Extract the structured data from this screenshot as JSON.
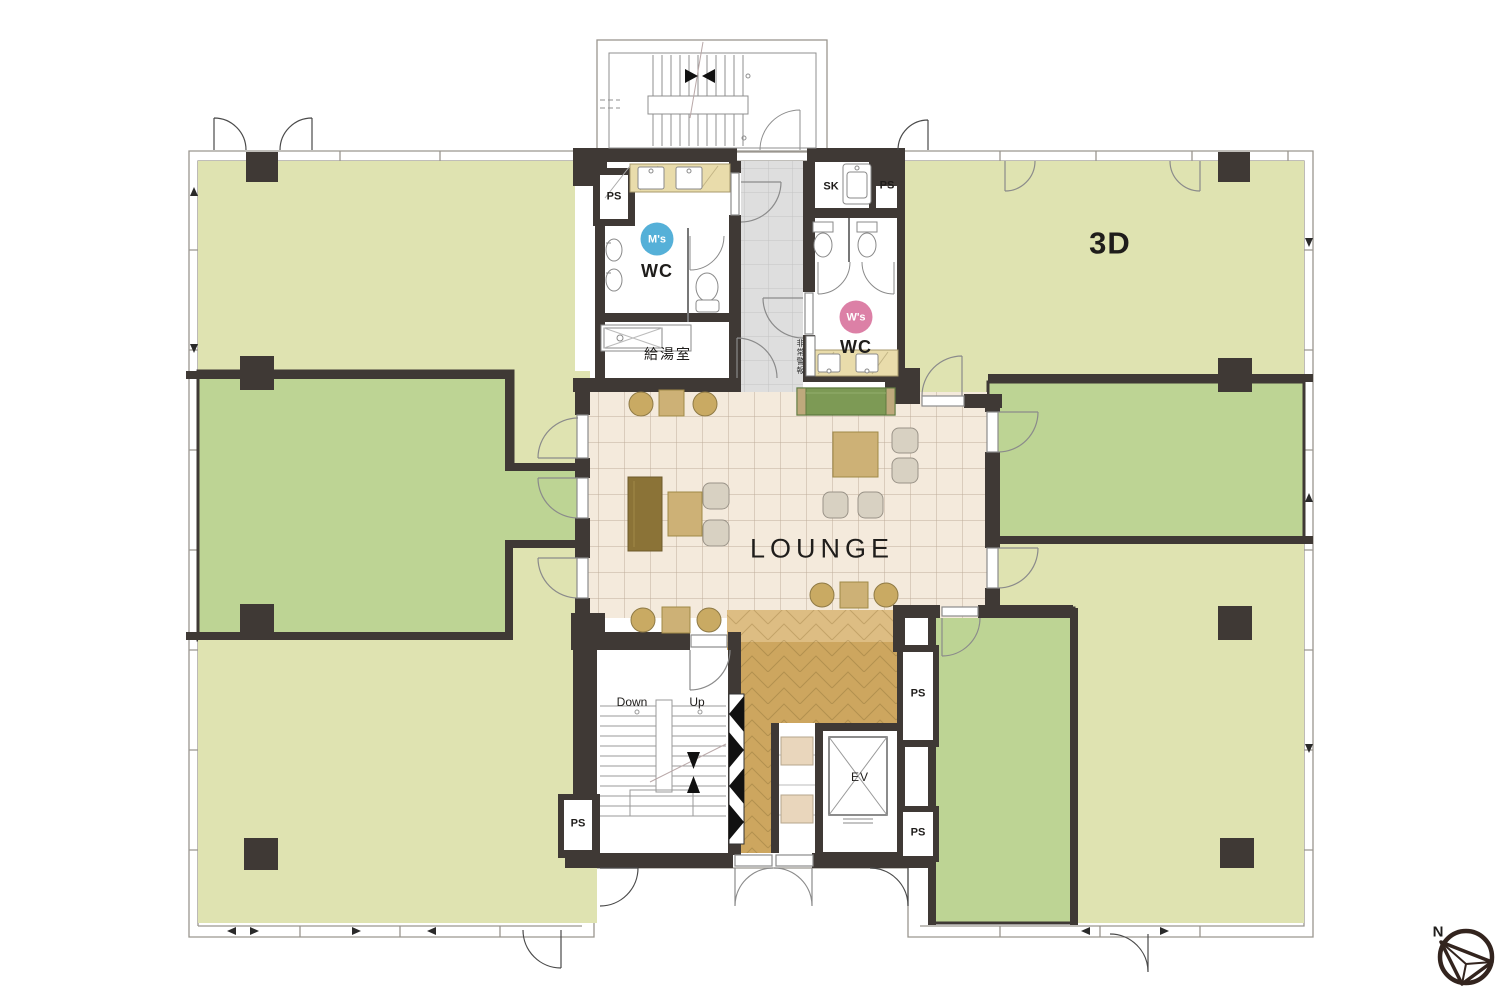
{
  "labels": {
    "tenant_room": "3D",
    "lounge": "LOUNGE",
    "mens_badge": "M's",
    "mens_wc": "WC",
    "womens_badge": "W's",
    "womens_wc": "WC",
    "kitchenette": "給湯室",
    "slop_sink": "SK",
    "elevator": "EV",
    "stair_down": "Down",
    "stair_up": "Up",
    "emergency_alarm": "非常警報",
    "north": "N",
    "pipe_shafts": [
      "PS",
      "PS",
      "PS",
      "PS",
      "PS"
    ]
  },
  "colors": {
    "wall": "#3f3935",
    "line": "#9a968f",
    "roomPale": "#dfe3b1",
    "roomGreen": "#bdd494",
    "loungeTile": "#f4eadc",
    "loungeGrid": "#bfae9b",
    "corridorTile": "#dedede",
    "corridorGrid": "#c4c4c4",
    "wood": "#cda65f",
    "woodLight": "#ddbd83",
    "woodLine": "#9c7e42",
    "counter": "#e9dcab",
    "cell": "#e9d6bc",
    "furnTan": "#cdb176",
    "furnDark": "#8b7337",
    "sofa": "#7d9a55",
    "sofaTrim": "#bfa97c",
    "chairGray": "#d8d1c2",
    "chairTan": "#c9aa63",
    "badgeBlue": "#55b0d8",
    "badgePink": "#dc80a6",
    "text": "#1f1d1b"
  }
}
